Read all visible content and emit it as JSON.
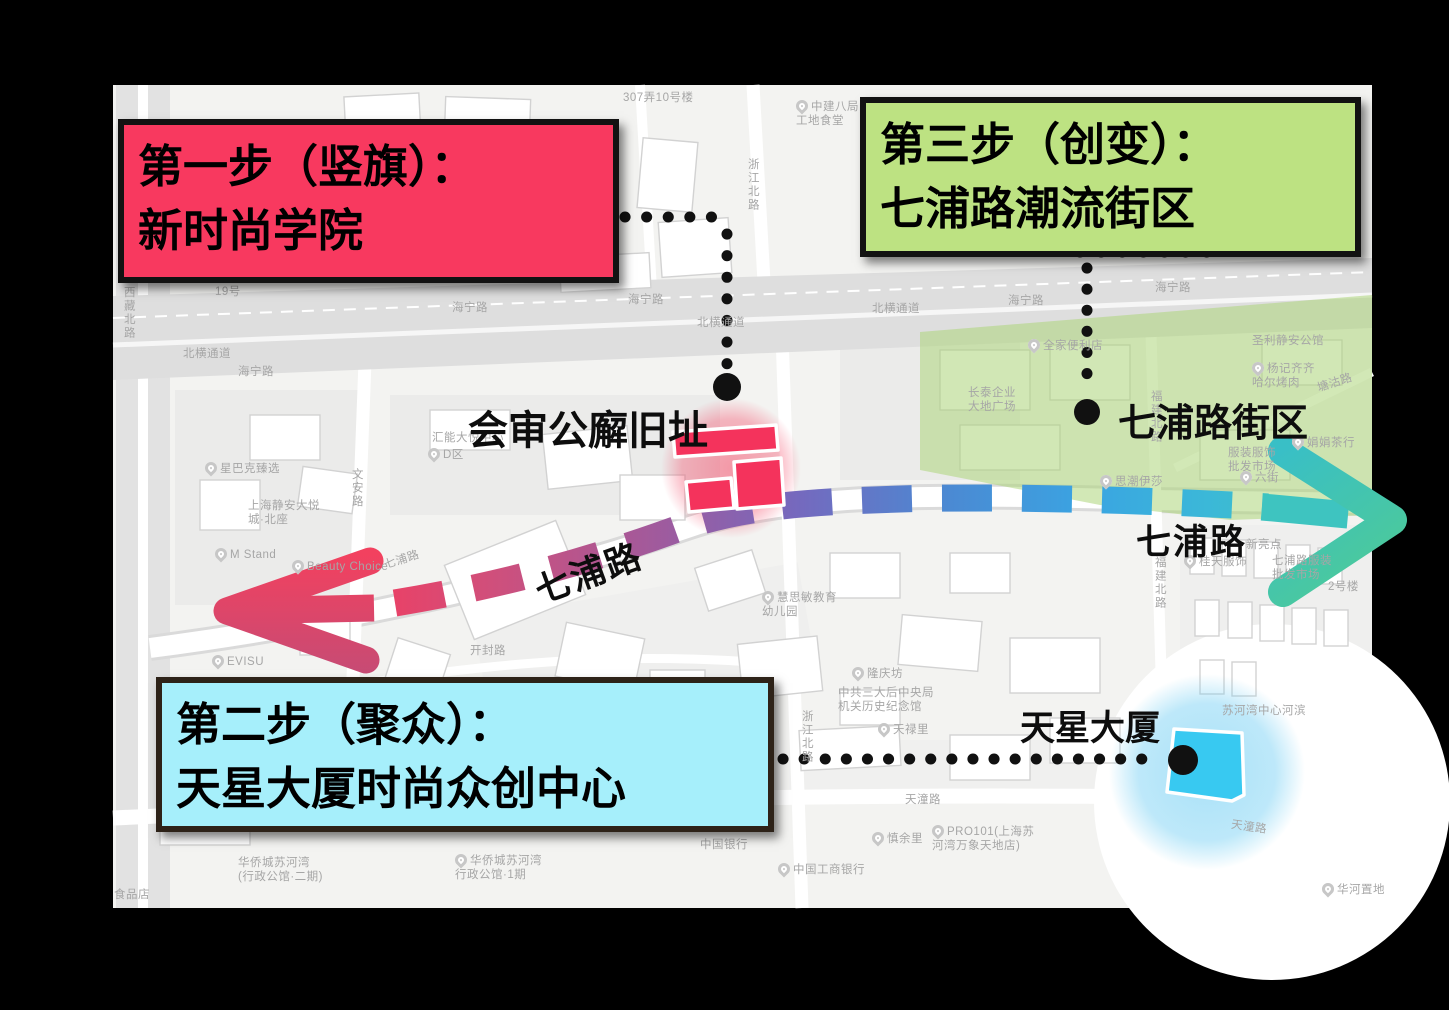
{
  "steps": [
    {
      "order": "first",
      "line1": "第一步（竖旗）：",
      "line2": "新时尚学院"
    },
    {
      "order": "second",
      "line1": "第二步（聚众）：",
      "line2": "天星大厦时尚众创中心"
    },
    {
      "order": "third",
      "line1": "第三步（创变）：",
      "line2": "七浦路潮流街区"
    }
  ],
  "landmarks": {
    "court": "会审公廨旧址",
    "qipu_block": "七浦路街区",
    "tianxing": "天星大厦",
    "qipu_road_left": "七浦路",
    "qipu_road_right": "七浦路"
  },
  "colors": {
    "background": "#000000",
    "map_base": "#f3f3f1",
    "step1_fill": "#F8395F",
    "step2_fill": "#A6EFFB",
    "step3_fill": "#BDE282",
    "box_border": "#121212",
    "step2_border": "#2D2218",
    "route_stops": [
      "#EE3F63",
      "#D04F7B",
      "#A15A9C",
      "#7569BE",
      "#4C88D2",
      "#3AA4E2",
      "#3BB8D8",
      "#3EC4C0",
      "#47C9A8"
    ],
    "arrow_left_top": "#F2415F",
    "arrow_left_bottom": "#C74B74",
    "arrow_right_start": "#39BFC6",
    "arrow_right_end": "#4FCB94",
    "building_red": "#F4335C",
    "building_cyan": "#38C9F1",
    "district_green": "rgba(173,214,122,0.55)",
    "glow_red": "rgba(243,63,94,0.5)",
    "glow_blue": "rgba(110,205,243,0.6)",
    "dot_black": "#111111"
  },
  "map_labels": [
    {
      "t": "307弄10号楼",
      "x": 623,
      "y": 92
    },
    {
      "t": "19号",
      "x": 215,
      "y": 286
    },
    {
      "t": "中建八局\n工地食堂",
      "x": 796,
      "y": 100,
      "pin": true
    },
    {
      "t": "浙江北路",
      "x": 745,
      "y": 158,
      "v": true
    },
    {
      "t": "西藏北路",
      "x": 121,
      "y": 286,
      "v": true
    },
    {
      "t": "北横通道",
      "x": 183,
      "y": 348
    },
    {
      "t": "海宁路",
      "x": 238,
      "y": 366
    },
    {
      "t": "海宁路",
      "x": 452,
      "y": 302
    },
    {
      "t": "海宁路",
      "x": 628,
      "y": 294
    },
    {
      "t": "北横通道",
      "x": 697,
      "y": 317
    },
    {
      "t": "北横通道",
      "x": 872,
      "y": 303
    },
    {
      "t": "海宁路",
      "x": 1008,
      "y": 295
    },
    {
      "t": "海宁路",
      "x": 1155,
      "y": 282
    },
    {
      "t": "汇能大悦中心",
      "x": 432,
      "y": 432
    },
    {
      "t": "D区",
      "x": 428,
      "y": 448,
      "pin": true
    },
    {
      "t": "星巴克臻选",
      "x": 205,
      "y": 462,
      "pin": true
    },
    {
      "t": "上海静安大悦\n城·北座",
      "x": 248,
      "y": 500
    },
    {
      "t": "M Stand",
      "x": 215,
      "y": 548,
      "pin": true
    },
    {
      "t": "Beauty Choice",
      "x": 292,
      "y": 560,
      "pin": true
    },
    {
      "t": "EVISU",
      "x": 212,
      "y": 655,
      "pin": true
    },
    {
      "t": "文安路",
      "x": 349,
      "y": 468,
      "v": true
    },
    {
      "t": "七浦路",
      "x": 383,
      "y": 560,
      "r": -18
    },
    {
      "t": "开封路",
      "x": 470,
      "y": 645
    },
    {
      "t": "慧思敏教育\n幼儿园",
      "x": 762,
      "y": 591,
      "pin": true
    },
    {
      "t": "隆庆坊",
      "x": 852,
      "y": 667,
      "pin": true
    },
    {
      "t": "中共三大后中央局\n机关历史纪念馆",
      "x": 838,
      "y": 687
    },
    {
      "t": "天禄里",
      "x": 878,
      "y": 723,
      "pin": true
    },
    {
      "t": "浙江北路",
      "x": 799,
      "y": 710,
      "v": true
    },
    {
      "t": "天潼路",
      "x": 905,
      "y": 794
    },
    {
      "t": "慎余里",
      "x": 872,
      "y": 832,
      "pin": true
    },
    {
      "t": "PRO101(上海苏\n河湾万象天地店)",
      "x": 932,
      "y": 825,
      "pin": true
    },
    {
      "t": "中国银行",
      "x": 700,
      "y": 839
    },
    {
      "t": "中国工商银行",
      "x": 778,
      "y": 863,
      "pin": true
    },
    {
      "t": "华侨城苏河湾\n(行政公馆·二期)",
      "x": 238,
      "y": 857
    },
    {
      "t": "华侨城苏河湾\n行政公馆·1期",
      "x": 455,
      "y": 854,
      "pin": true
    },
    {
      "t": "食品店",
      "x": 114,
      "y": 889
    },
    {
      "t": "全家便利店",
      "x": 1028,
      "y": 339,
      "pin": true
    },
    {
      "t": "长泰企业\n大地广场",
      "x": 968,
      "y": 387
    },
    {
      "t": "福建北路",
      "x": 1148,
      "y": 390,
      "v": true
    },
    {
      "t": "圣利静安公馆",
      "x": 1252,
      "y": 335
    },
    {
      "t": "杨记齐齐\n哈尔烤肉",
      "x": 1252,
      "y": 362,
      "pin": true
    },
    {
      "t": "塘沽路",
      "x": 1316,
      "y": 383,
      "r": -18
    },
    {
      "t": "娟娟茶行",
      "x": 1292,
      "y": 436,
      "pin": true
    },
    {
      "t": "服装服饰\n批发市场",
      "x": 1228,
      "y": 447
    },
    {
      "t": "六街",
      "x": 1240,
      "y": 471,
      "pin": true
    },
    {
      "t": "思潮伊莎",
      "x": 1100,
      "y": 475,
      "pin": true
    },
    {
      "t": "新亮点",
      "x": 1246,
      "y": 539
    },
    {
      "t": "桂天服饰",
      "x": 1184,
      "y": 555,
      "pin": true
    },
    {
      "t": "七浦路服装\n批发市场",
      "x": 1272,
      "y": 555
    },
    {
      "t": "福建北路",
      "x": 1152,
      "y": 556,
      "v": true
    },
    {
      "t": "2号楼",
      "x": 1328,
      "y": 581
    },
    {
      "t": "苏河湾中心河滨",
      "x": 1222,
      "y": 705
    },
    {
      "t": "天潼路",
      "x": 1232,
      "y": 819,
      "r": 8
    },
    {
      "t": "华河置地",
      "x": 1322,
      "y": 883,
      "pin": true
    }
  ]
}
